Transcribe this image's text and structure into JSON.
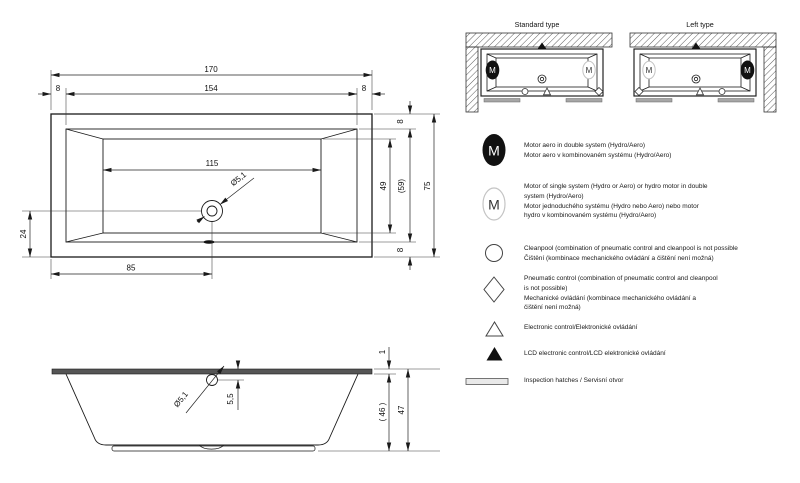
{
  "page": {
    "background": "#ffffff"
  },
  "colors": {
    "line": "#1a1a1a",
    "rim_bar": "#555555",
    "inspection_bar": "#a6a6a6",
    "motor_fill": "#111111",
    "motor_outline": "#c4c4c4"
  },
  "drawing": {
    "top_view": {
      "width_total": "170",
      "rim_left": "8",
      "width_inner": "154",
      "rim_right": "8",
      "width_basin": "115",
      "drain_from_left": "85",
      "drain_from_bottom": "24",
      "rim_top": "8",
      "height_basin": "49",
      "height_inner": "(59)",
      "height_total": "75",
      "rim_bottom": "8",
      "drain_diameter": "Ø5,1"
    },
    "side_view": {
      "rim_thickness": "1",
      "drain_to_rim": "5,5",
      "depth_inner": "( 46 )",
      "height_total": "47",
      "drain_diameter": "Ø5,1"
    }
  },
  "types": {
    "standard_label": "Standard type",
    "left_label": "Left type",
    "motor_letter": "M"
  },
  "legend": {
    "items": [
      {
        "icon": "motor-aero-filled-icon",
        "text": "Motor aero in double system (Hydro/Aero)\nMotor aero v kombinovaném systému (Hydro/Aero)"
      },
      {
        "icon": "motor-single-icon",
        "text": "Motor of single system (Hydro or Aero) or hydro motor in double\nsystem (Hydro/Aero)\nMotor jednoduchého systému (Hydro nebo Aero) nebo motor\nhydro v kombinovaném systému (Hydro/Aero)"
      },
      {
        "icon": "cleanpool-circle-icon",
        "text": "Cleanpool (combination of pneumatic control and cleanpool is not possible\nČištění (kombinace mechanického ovládání a čištění není možná)"
      },
      {
        "icon": "pneumatic-diamond-icon",
        "text": "Pneumatic control (combination of pneumatic control and cleanpool\nis not possible)\nMechanické ovládání (kombinace mechanického ovládání a\nčištění není možná)"
      },
      {
        "icon": "electronic-triangle-icon",
        "text": "Electronic control/Elektronické ovládání"
      },
      {
        "icon": "lcd-triangle-filled-icon",
        "text": "LCD electronic control/LCD elektronické ovládání"
      },
      {
        "icon": "inspection-hatch-icon",
        "text": "Inspection hatches / Servisní otvor"
      }
    ]
  }
}
